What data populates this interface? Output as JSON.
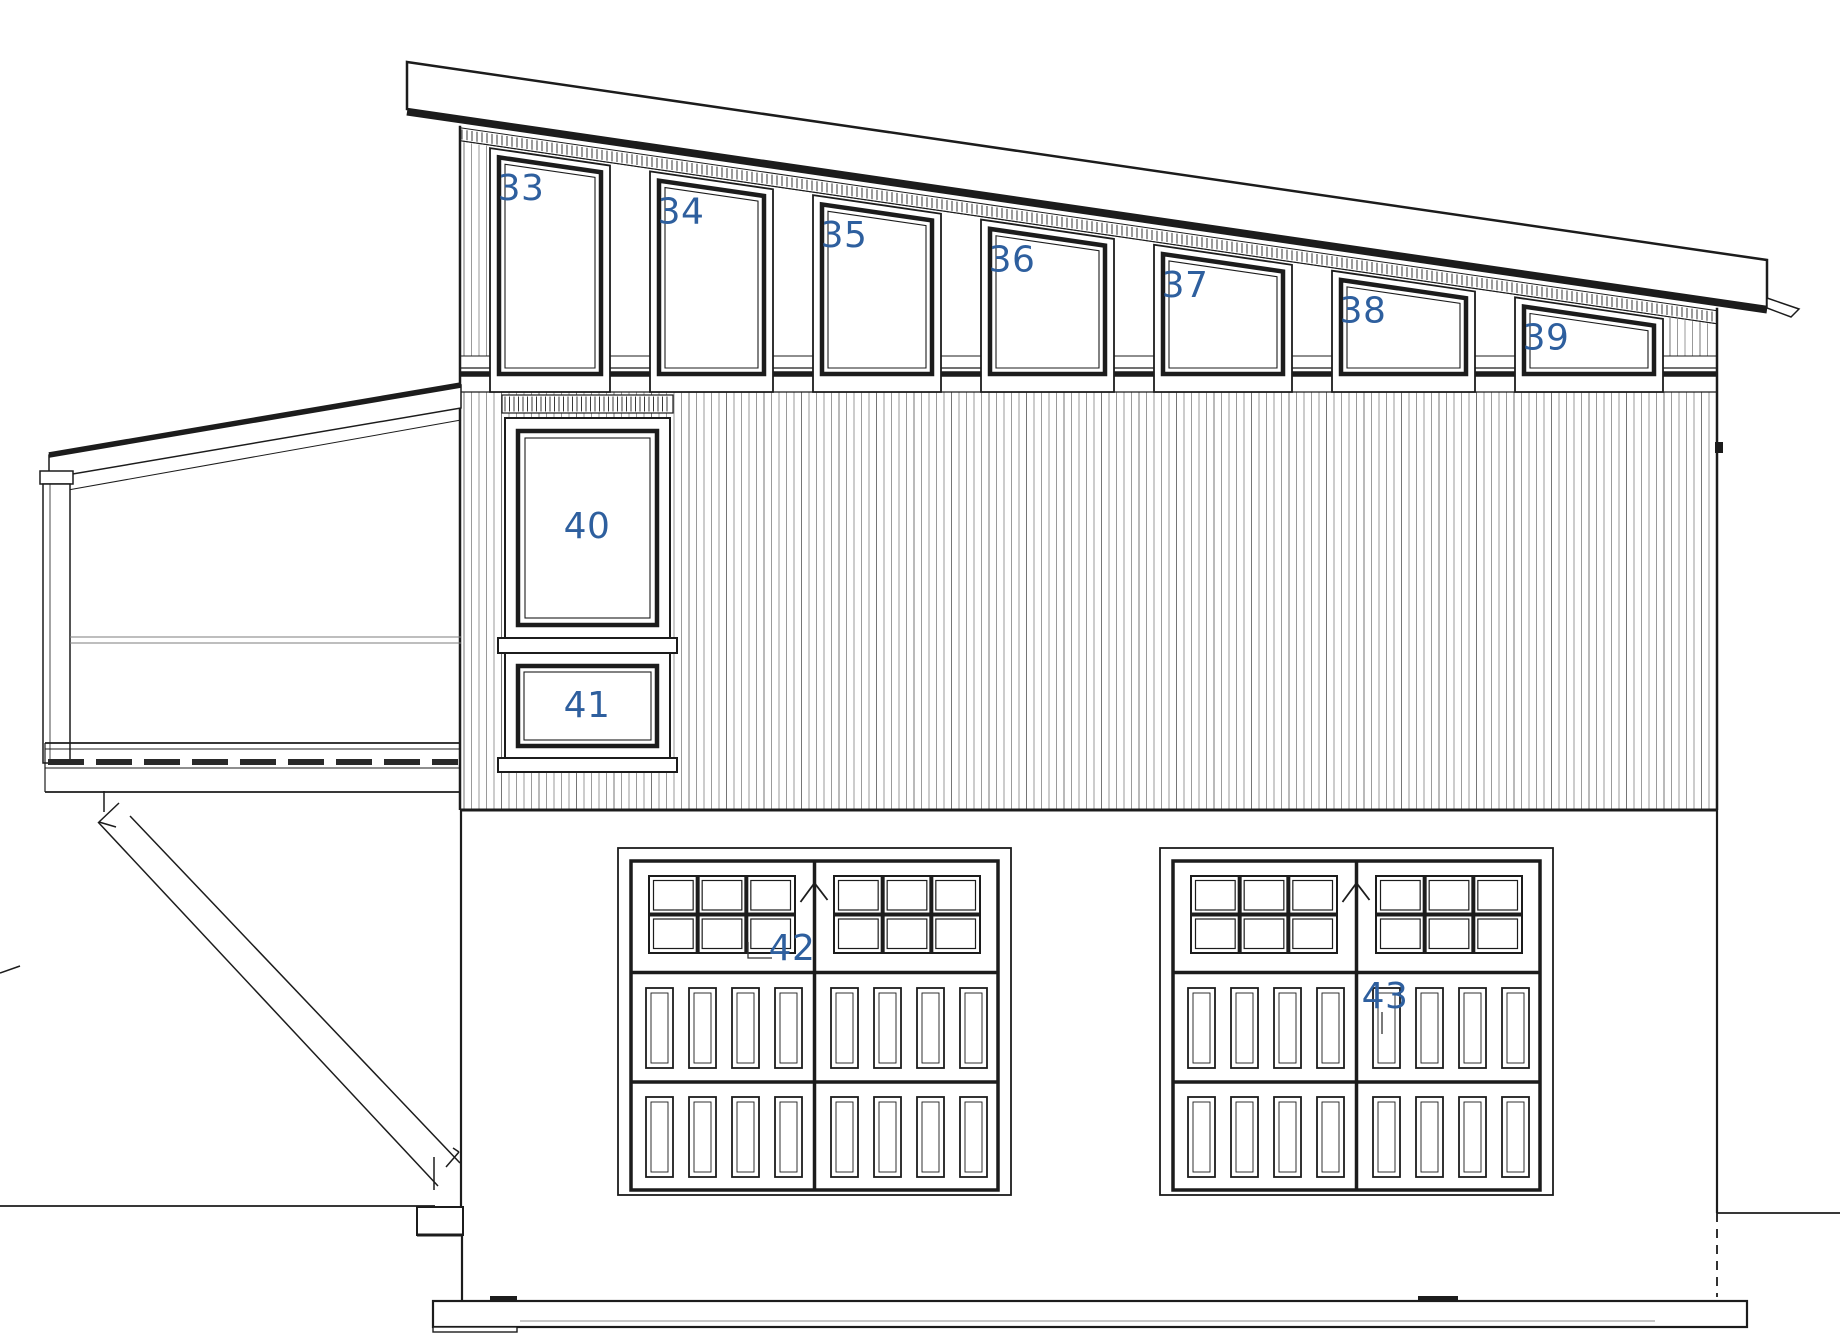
{
  "drawing": {
    "kind": "architectural-elevation",
    "description": "Side elevation, shed roof garage with clerestory windows and two carriage garage doors"
  },
  "windows": {
    "clerestory": [
      {
        "label": "33"
      },
      {
        "label": "34"
      },
      {
        "label": "35"
      },
      {
        "label": "36"
      },
      {
        "label": "37"
      },
      {
        "label": "38"
      },
      {
        "label": "39"
      }
    ],
    "left_column": [
      {
        "label": "40"
      },
      {
        "label": "41"
      }
    ]
  },
  "garage_doors": [
    {
      "label": "42"
    },
    {
      "label": "43"
    }
  ],
  "colors": {
    "ink": "#1c1c1c",
    "label_blue": "#2e5f9e",
    "siding_gray": "#8f8f8f",
    "siding_dark": "#666666",
    "rail_gray": "#7d7d7d",
    "tick_dark": "#222222"
  }
}
